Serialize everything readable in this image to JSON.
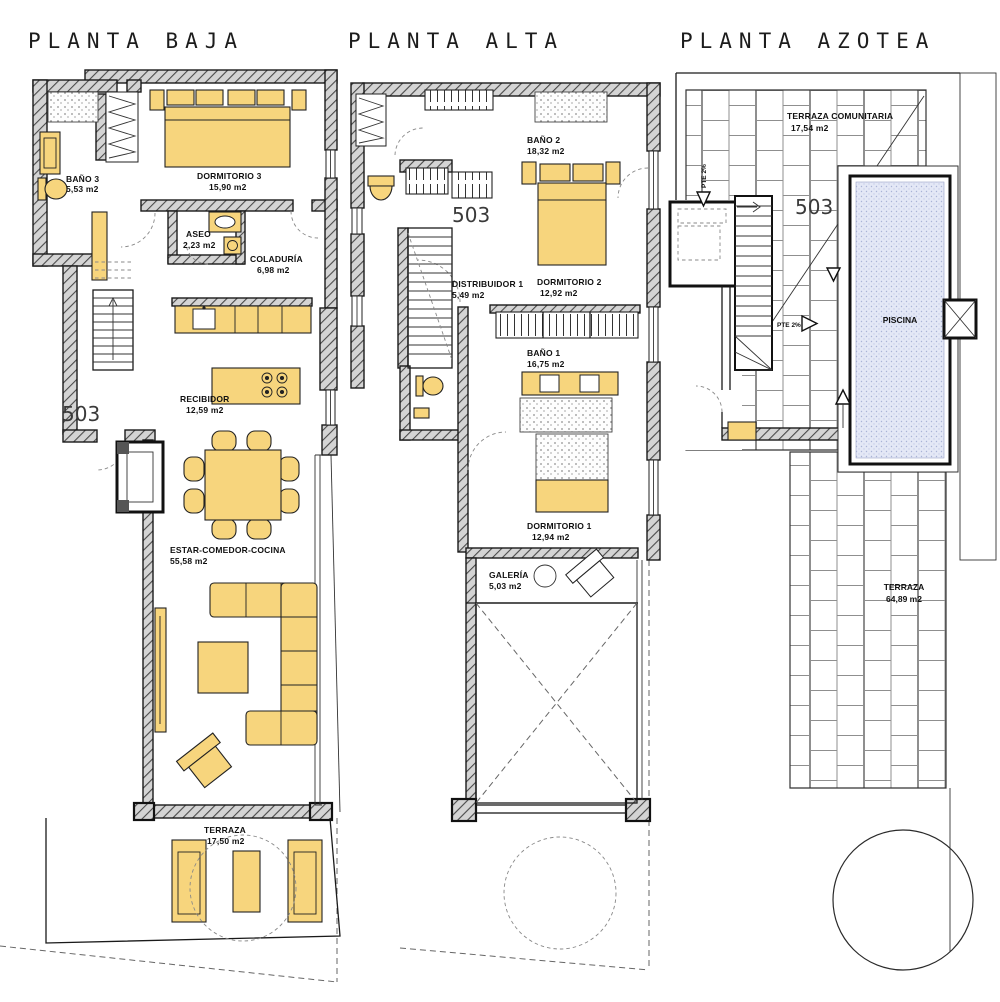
{
  "document": {
    "type": "residential floor plan set",
    "language": "es"
  },
  "titles": {
    "baja": "PLANTA BAJA",
    "alta": "PLANTA ALTA",
    "azotea": "PLANTA AZOTEA"
  },
  "unit": {
    "number": "503"
  },
  "baja": {
    "rooms": [
      {
        "name": "BAÑO 3",
        "area": "5,53 m2"
      },
      {
        "name": "DORMITORIO 3",
        "area": "15,90 m2"
      },
      {
        "name": "ASEO",
        "area": "2,23 m2"
      },
      {
        "name": "COLADURÍA",
        "area": "6,98 m2"
      },
      {
        "name": "RECIBIDOR",
        "area": "12,59 m2"
      },
      {
        "name": "ESTAR-COMEDOR-COCINA",
        "area": "55,58 m2"
      },
      {
        "name": "TERRAZA",
        "area": "17,50 m2"
      }
    ]
  },
  "alta": {
    "rooms": [
      {
        "name": "BAÑO 2",
        "area": "18,32 m2"
      },
      {
        "name": "DISTRIBUIDOR 1",
        "area": "5,49 m2"
      },
      {
        "name": "DORMITORIO 2",
        "area": "12,92 m2"
      },
      {
        "name": "BAÑO 1",
        "area": "16,75 m2"
      },
      {
        "name": "DORMITORIO 1",
        "area": "12,94 m2"
      },
      {
        "name": "GALERÍA",
        "area": "5,03 m2"
      }
    ]
  },
  "azotea": {
    "rooms": [
      {
        "name": "TERRAZA COMUNITARIA",
        "area": "17,54 m2"
      },
      {
        "name": "PISCINA",
        "area": ""
      },
      {
        "name": "TERRAZA",
        "area": "64,89 m2"
      }
    ],
    "slope": "PTE 2%"
  },
  "colors": {
    "furniture": "#f7d57d",
    "pool": "#e4e8f6",
    "wall_fill": "#d4d4d4"
  }
}
